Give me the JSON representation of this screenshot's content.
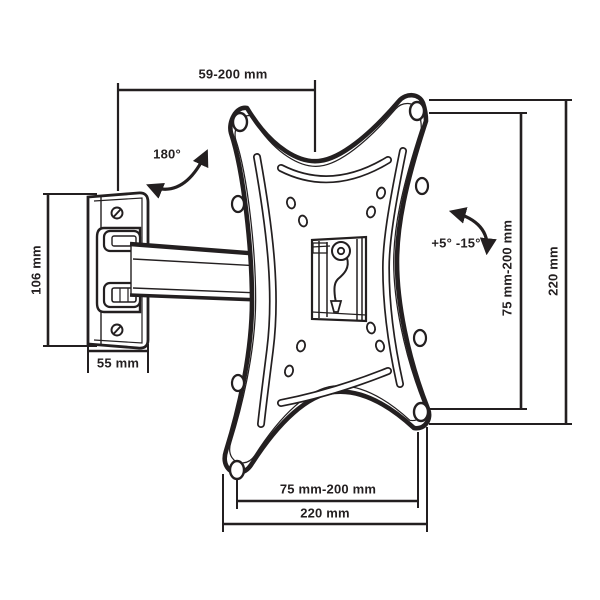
{
  "diagram": {
    "kind": "technical-drawing",
    "subject": "wall mount bracket with swivel arm and VESA plate"
  },
  "colors": {
    "ink": "#231f20",
    "background": "#ffffff"
  },
  "annotations": {
    "arm_extension": "59-200 mm",
    "swivel_angle": "180°",
    "wall_plate_height": "106 mm",
    "wall_plate_width": "55 mm",
    "tilt_angle": "+5° -15°",
    "vesa_height": "75 mm-200 mm",
    "bracket_height": "220 mm",
    "vesa_width": "75 mm-200 mm",
    "bracket_width": "220 mm"
  }
}
